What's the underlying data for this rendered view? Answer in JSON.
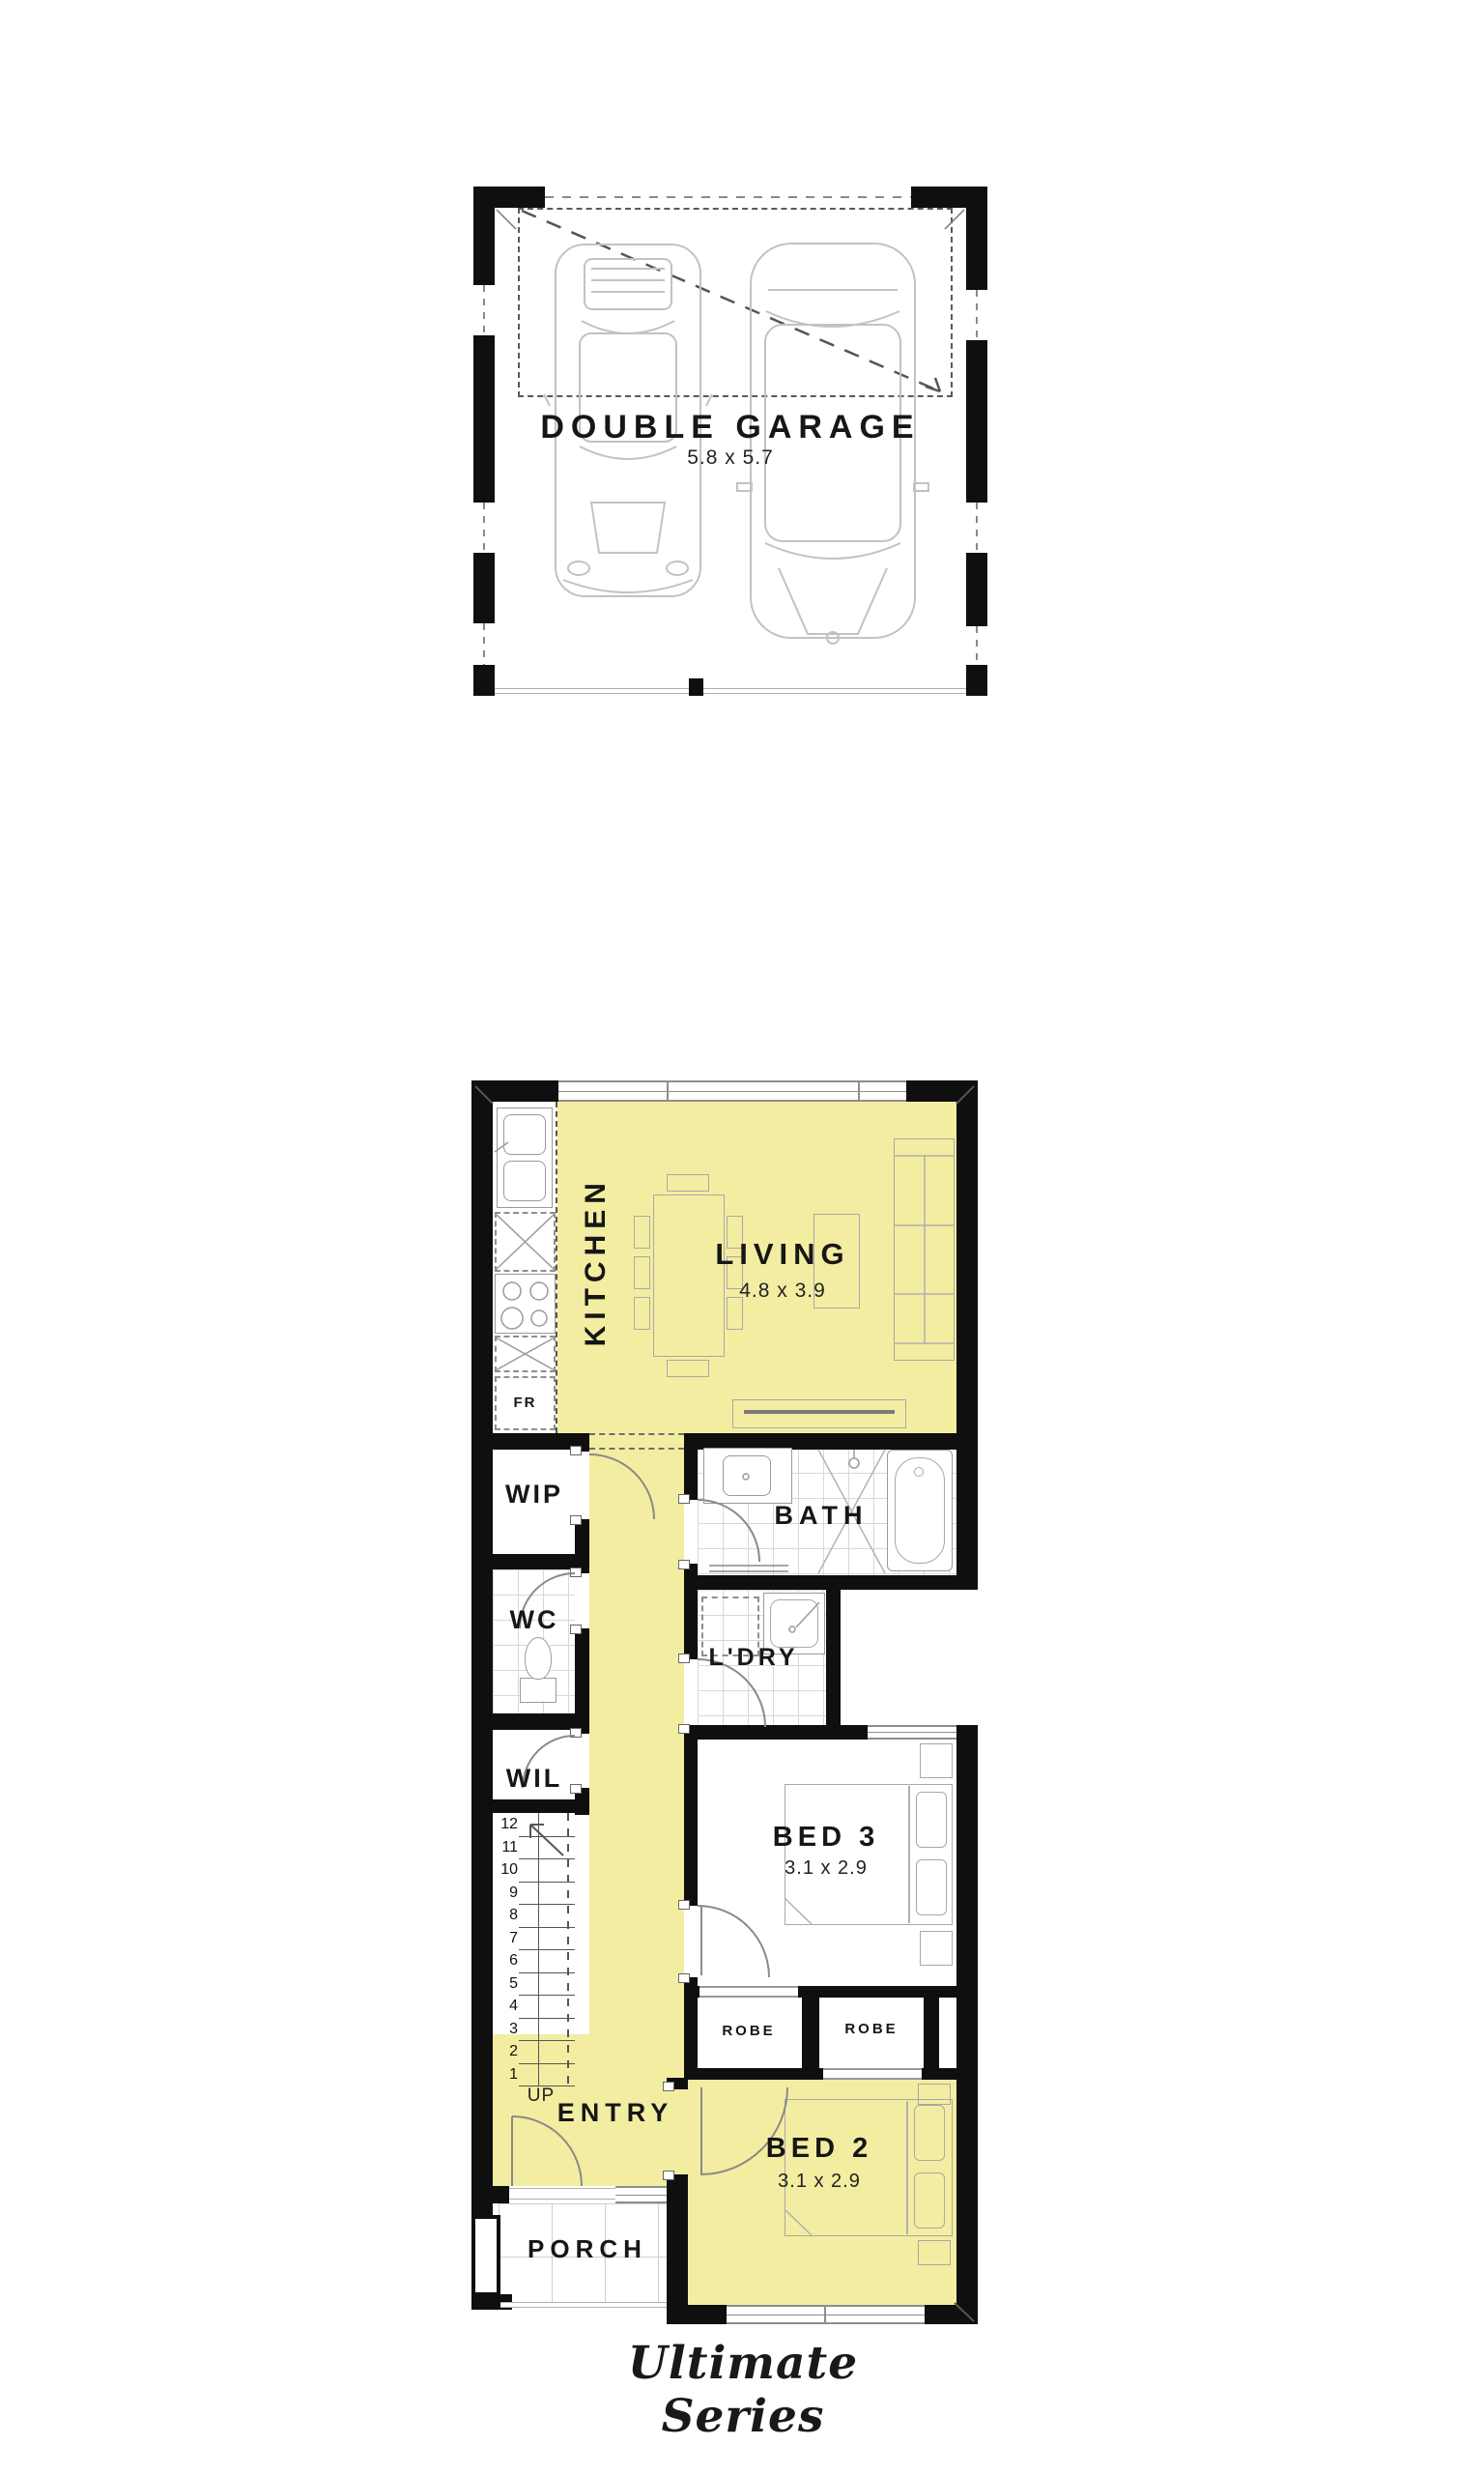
{
  "series_label": "Ultimate Series",
  "garage": {
    "label": "DOUBLE GARAGE",
    "dims": "5.8 x 5.7"
  },
  "ground": {
    "kitchen": "KITCHEN",
    "living": "LIVING",
    "living_dims": "4.8 x 3.9",
    "fr": "FR",
    "wip": "WIP",
    "wc": "WC",
    "wil": "WIL",
    "bath": "BATH",
    "ldry": "L'DRY",
    "bed3": "BED 3",
    "bed3_dims": "3.1 x 2.9",
    "robe_left": "ROBE",
    "robe_right": "ROBE",
    "bed2": "BED 2",
    "bed2_dims": "3.1 x 2.9",
    "entry": "ENTRY",
    "up": "UP",
    "porch": "PORCH",
    "stairs": [
      "12",
      "11",
      "10",
      "9",
      "8",
      "7",
      "6",
      "5",
      "4",
      "3",
      "2",
      "1"
    ]
  },
  "colors": {
    "highlight": "#F3EDA1",
    "wall": "#0f0f0f",
    "line": "#9a9a9a"
  }
}
